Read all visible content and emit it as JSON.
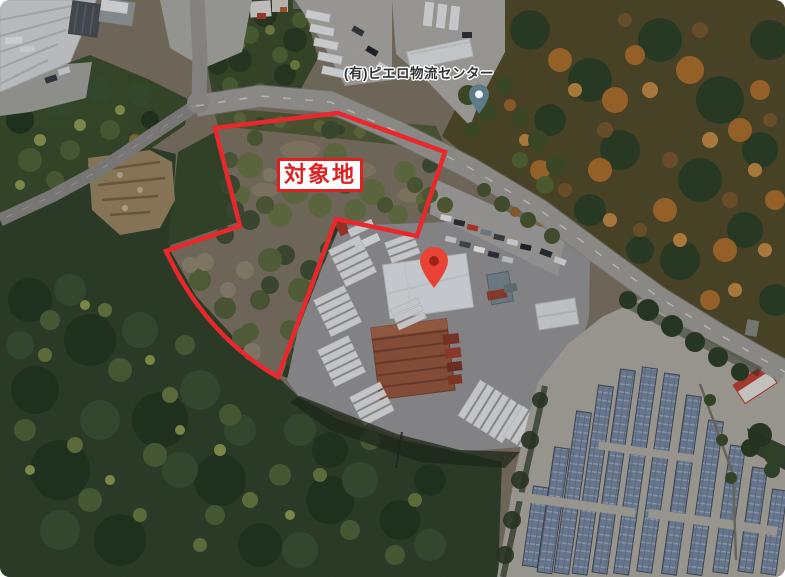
{
  "labels": {
    "target_site": "対象地",
    "poi_name": "(有)ピエロ物流センター"
  },
  "markers": {
    "target_pin": {
      "icon": "red-map-pin-icon",
      "color": "#EA4335",
      "dot_color": "#9E2317"
    },
    "poi_pin": {
      "icon": "teal-poi-pin-icon",
      "color": "#5D7B86",
      "dot_color": "#F1F5F5"
    }
  },
  "overlay": {
    "boundary_color": "#E8282C",
    "target_label_color": "#DE2020",
    "target_label_bg": "#FFFFFF",
    "poi_label_color": "#2F3335"
  }
}
